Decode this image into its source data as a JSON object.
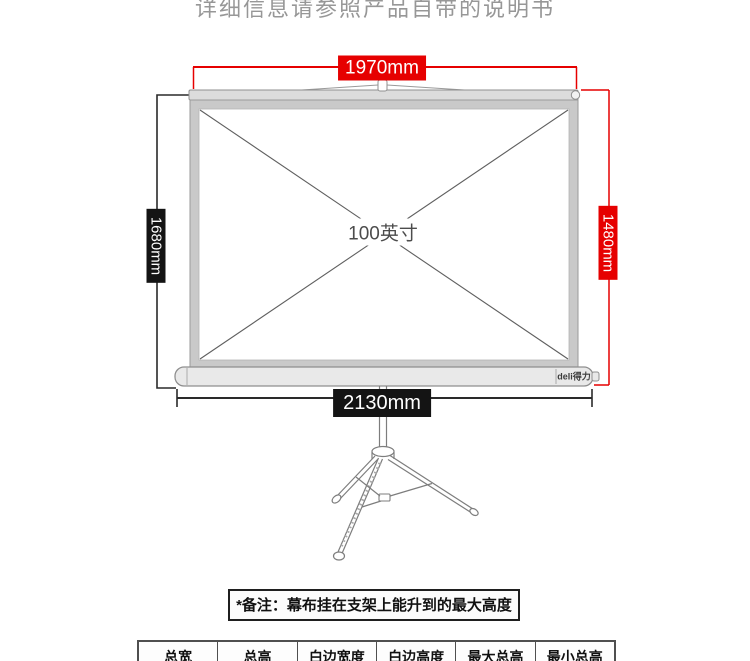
{
  "page": {
    "caption": "详细信息请参照产品自带的说明书"
  },
  "diagram": {
    "screen_size_label": "100英寸",
    "brand_label": "deli得力",
    "dimensions": {
      "top": "1970mm",
      "left": "1680mm",
      "right": "1480mm",
      "bottom": "2130mm"
    },
    "colors": {
      "dimension_red": "#e60000",
      "dimension_black": "#141414"
    }
  },
  "note": {
    "text": "*备注：幕布挂在支架上能升到的最大高度"
  },
  "spec_table": {
    "columns": [
      "总宽",
      "总高",
      "白边宽度",
      "白边高度",
      "最大总高",
      "最小总高"
    ]
  }
}
